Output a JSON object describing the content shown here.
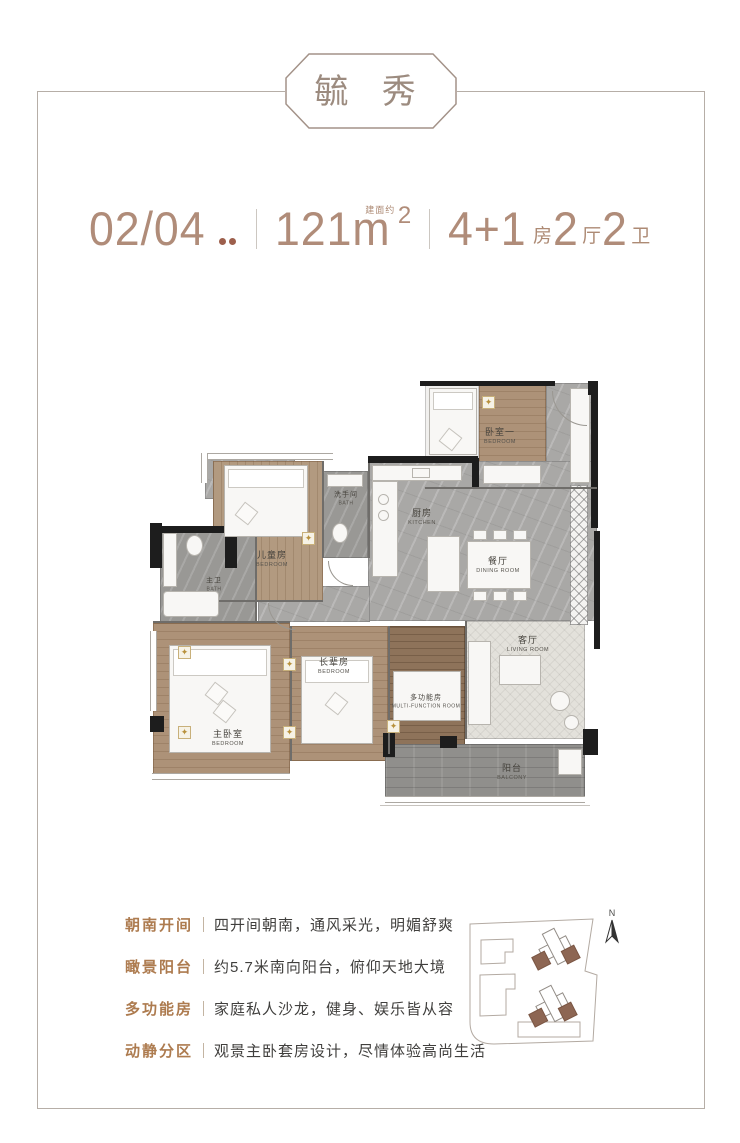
{
  "title": {
    "text": "毓 秀"
  },
  "header": {
    "unit": "02/04",
    "unit_dots_count": 2,
    "area_value": "121m",
    "area_sup": "2",
    "area_note": "建面约",
    "layout": [
      {
        "num": "4+1",
        "unit": "房"
      },
      {
        "num": "2",
        "unit": "厅"
      },
      {
        "num": "2",
        "unit": "卫"
      }
    ]
  },
  "plan": {
    "rooms": [
      {
        "cn": "卧室一",
        "en": "BEDROOM"
      },
      {
        "cn": "洗手间",
        "en": "BATH"
      },
      {
        "cn": "儿童房",
        "en": "BEDROOM"
      },
      {
        "cn": "厨房",
        "en": "KITCHEN"
      },
      {
        "cn": "餐厅",
        "en": "DINING ROOM"
      },
      {
        "cn": "主卫",
        "en": "BATH"
      },
      {
        "cn": "主卧室",
        "en": "BEDROOM"
      },
      {
        "cn": "长辈房",
        "en": "BEDROOM"
      },
      {
        "cn": "多功能房",
        "en": "MULTI-FUNCTION ROOM"
      },
      {
        "cn": "客厅",
        "en": "LIVING ROOM"
      },
      {
        "cn": "阳台",
        "en": "BALCONY"
      }
    ]
  },
  "features": [
    {
      "label": "朝南开间",
      "text": "四开间朝南，通风采光，明媚舒爽"
    },
    {
      "label": "瞰景阳台",
      "text": "约5.7米南向阳台，俯仰天地大境"
    },
    {
      "label": "多功能房",
      "text": "家庭私人沙龙，健身、娱乐皆从容"
    },
    {
      "label": "动静分区",
      "text": "观景主卧套房设计，尽情体验高尚生活"
    }
  ],
  "siteplan": {
    "north_label": "N"
  },
  "colors": {
    "accent_brown": "#b08c79",
    "dot_brown": "#9d5f4c",
    "feature_label_brown": "#ad7b4f",
    "text_dark": "#403f3d",
    "frame_gray": "#b6aea7",
    "wood": "#ad9278",
    "wood_dark": "#8e735a",
    "tile_gray": "#a9a8a6",
    "balcony_gray": "#908f8c",
    "wall_black": "#1d1d1d",
    "gold_decor": "#b8913c",
    "site_building_brown": "#8d6653"
  }
}
